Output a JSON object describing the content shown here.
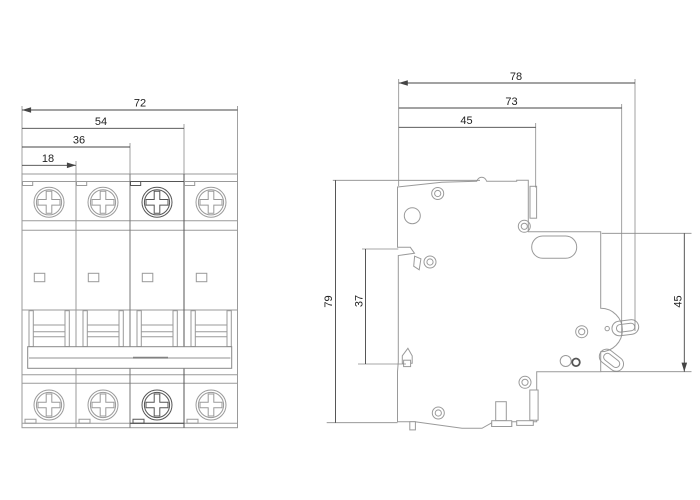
{
  "colors": {
    "background": "#ffffff",
    "outline": "#9a9a9a",
    "outline_strong": "#555555",
    "dim_line": "#454545",
    "dim_text": "#222222",
    "ext_line": "#8a8a8a",
    "tiebar_inner": "#b5b5b5"
  },
  "front_view": {
    "dims": [
      {
        "label": "72"
      },
      {
        "label": "54"
      },
      {
        "label": "36"
      },
      {
        "label": "18"
      }
    ]
  },
  "side_view": {
    "dims_horizontal": [
      {
        "label": "78"
      },
      {
        "label": "73"
      },
      {
        "label": "45"
      }
    ],
    "dims_vertical": [
      {
        "label": "79"
      },
      {
        "label": "37"
      },
      {
        "label": "45"
      }
    ]
  }
}
